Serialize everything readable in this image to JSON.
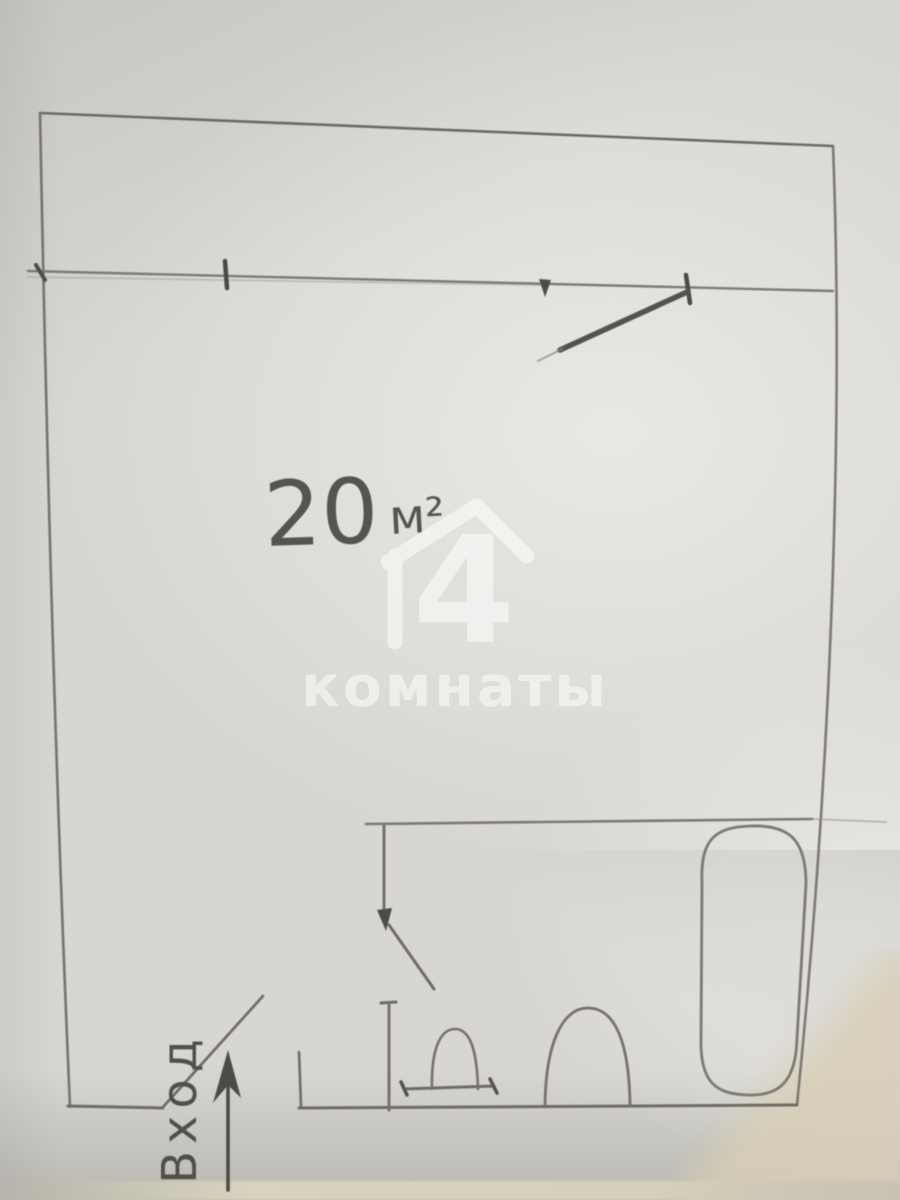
{
  "plan": {
    "area_value": "20",
    "area_unit": "м²",
    "entrance_label": "Вход",
    "fixtures": [
      "bathtub",
      "toilet",
      "sink"
    ],
    "doors": [
      "entrance-door-swing",
      "bathroom-door-swing",
      "room-door-leaf"
    ],
    "openings": [
      "window-ticks-top-wall",
      "entrance-opening-bottom-wall"
    ]
  },
  "watermark": {
    "logo_number": "4",
    "brand_text": "комнаты",
    "color": "#ffffff"
  },
  "colors": {
    "paper": "#d8d6d1",
    "paper_edge": "#d5d0bb",
    "pencil_light": "#8a8880",
    "pencil": "#716f69",
    "pencil_dark": "#504e49"
  }
}
